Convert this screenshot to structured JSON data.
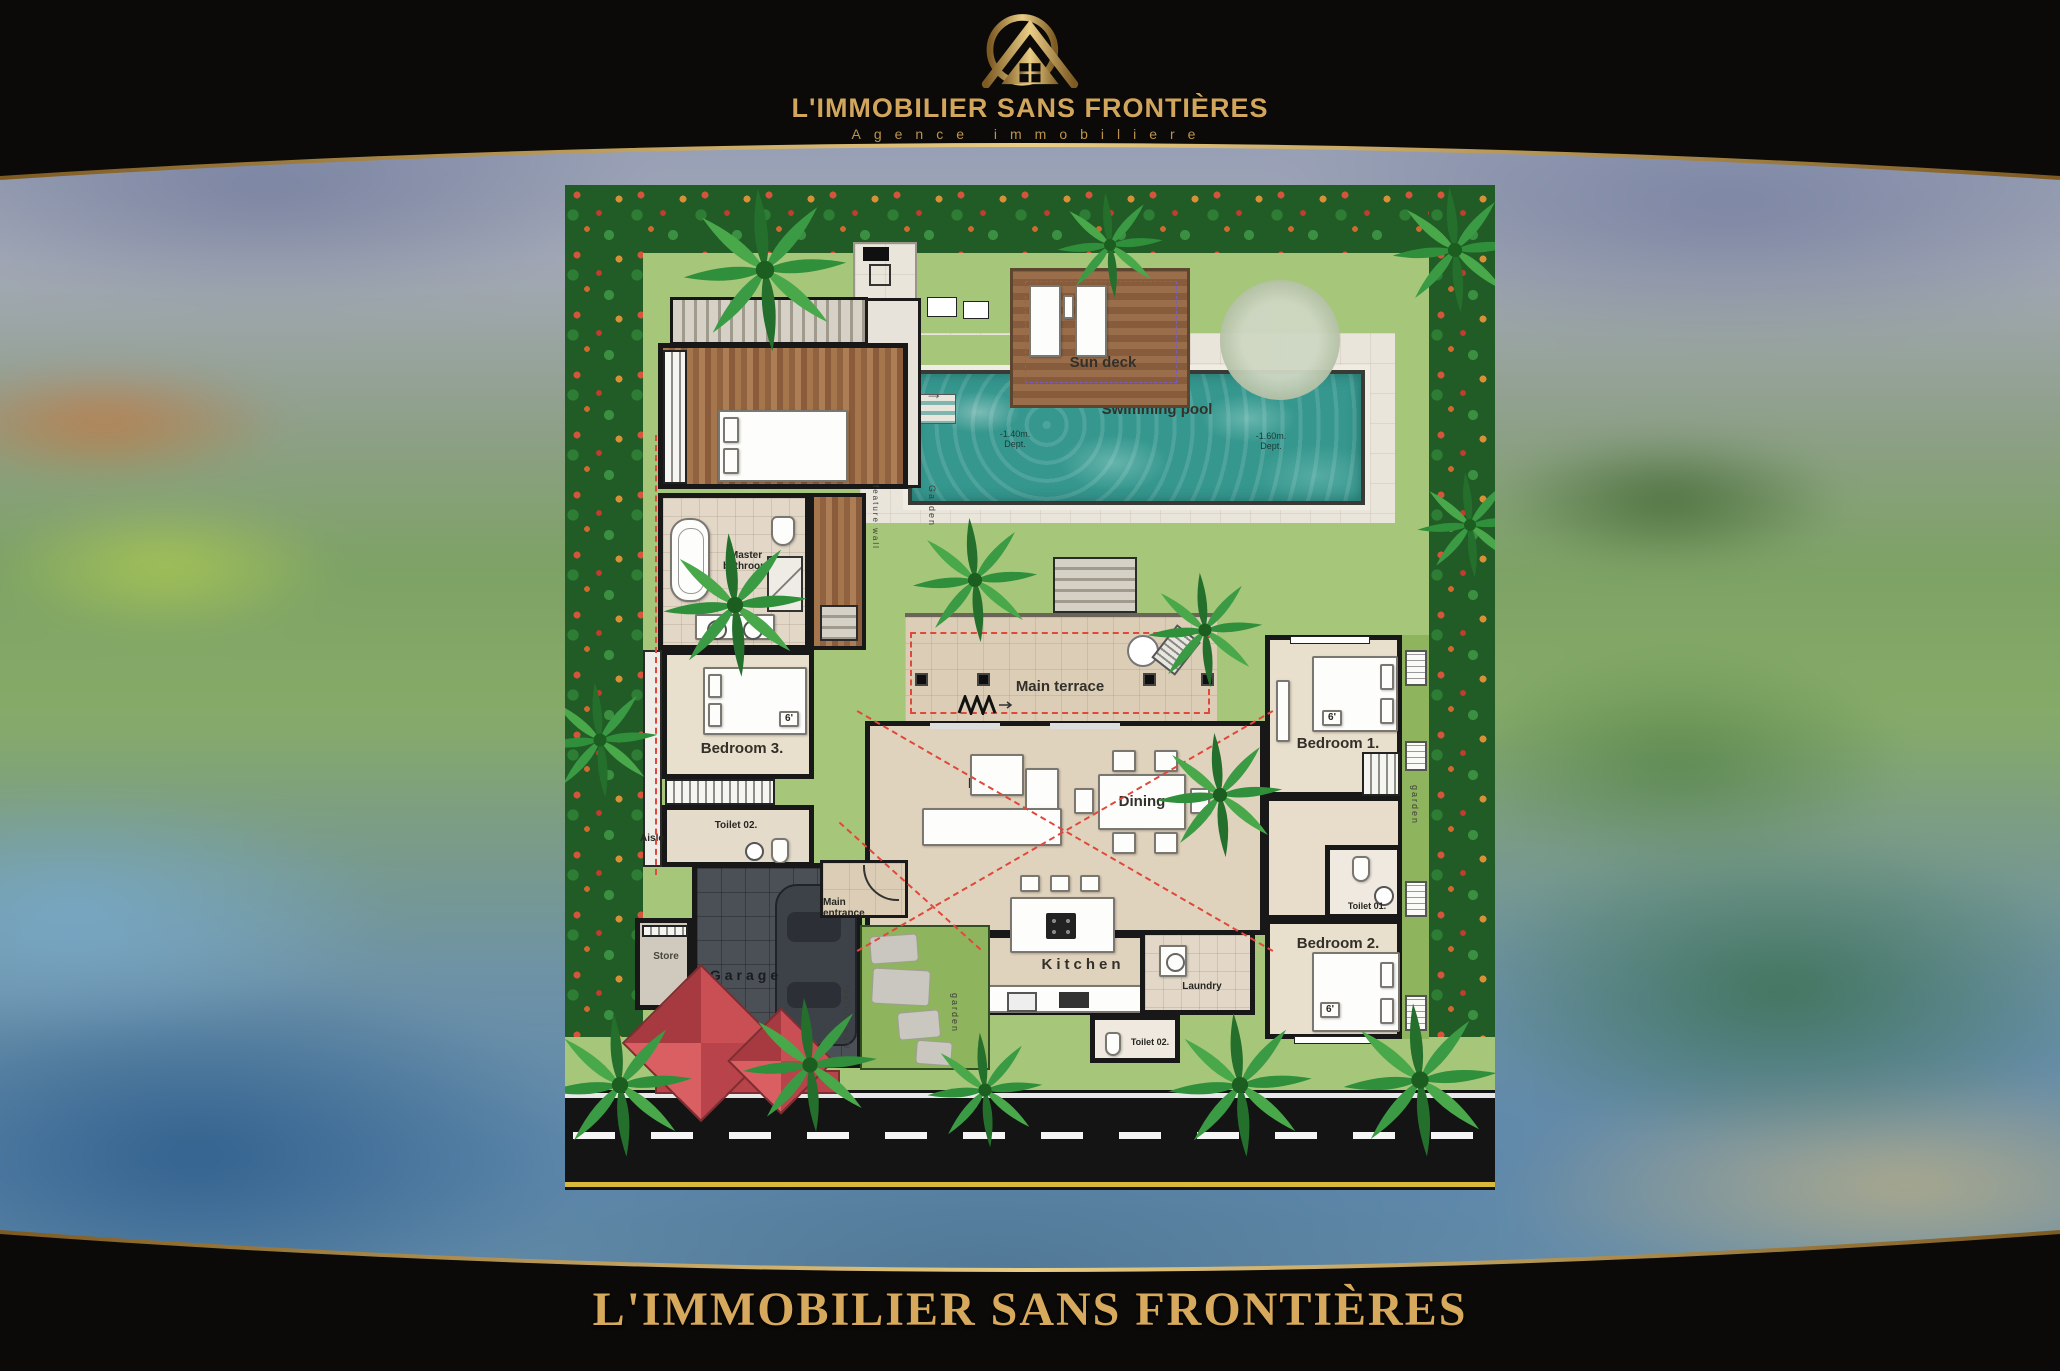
{
  "header": {
    "brand": "L'IMMOBILIER SANS FRONTIÈRES",
    "tagline": "Agence immobiliere"
  },
  "footer": {
    "brand": "L'IMMOBILIER SANS FRONTIÈRES"
  },
  "plan": {
    "rooms": {
      "sun_deck": "Sun deck",
      "swimming_pool": "Swimming pool",
      "depth_left": "-1.40m. Dept.",
      "depth_right": "-1.60m. Dept.",
      "dn": "DN.",
      "terrace": "Terrace",
      "master_bathroom": "Master bathroom",
      "bedroom_1": "Bedroom 1.",
      "bedroom_2": "Bedroom 2.",
      "bedroom_3": "Bedroom 3.",
      "toilet_01": "Toilet 01.",
      "toilet_02": "Toilet 02.",
      "aisle": "Aisle",
      "main_terrace": "Main terrace",
      "living": "Living",
      "dining": "Dining",
      "kitchen": "Kitchen",
      "laundry": "Laundry",
      "store": "Store",
      "garage": "Garage",
      "main_entrance": "Main entrance",
      "garden_vertical": "Garden",
      "garden_small": "garden",
      "feature_wall": "feature wall",
      "bed_size": "6'"
    },
    "colors": {
      "gold": "#d2a55d",
      "hedge": "#215c26",
      "pool": "#35978e",
      "roof_red": "#c94f55"
    }
  }
}
